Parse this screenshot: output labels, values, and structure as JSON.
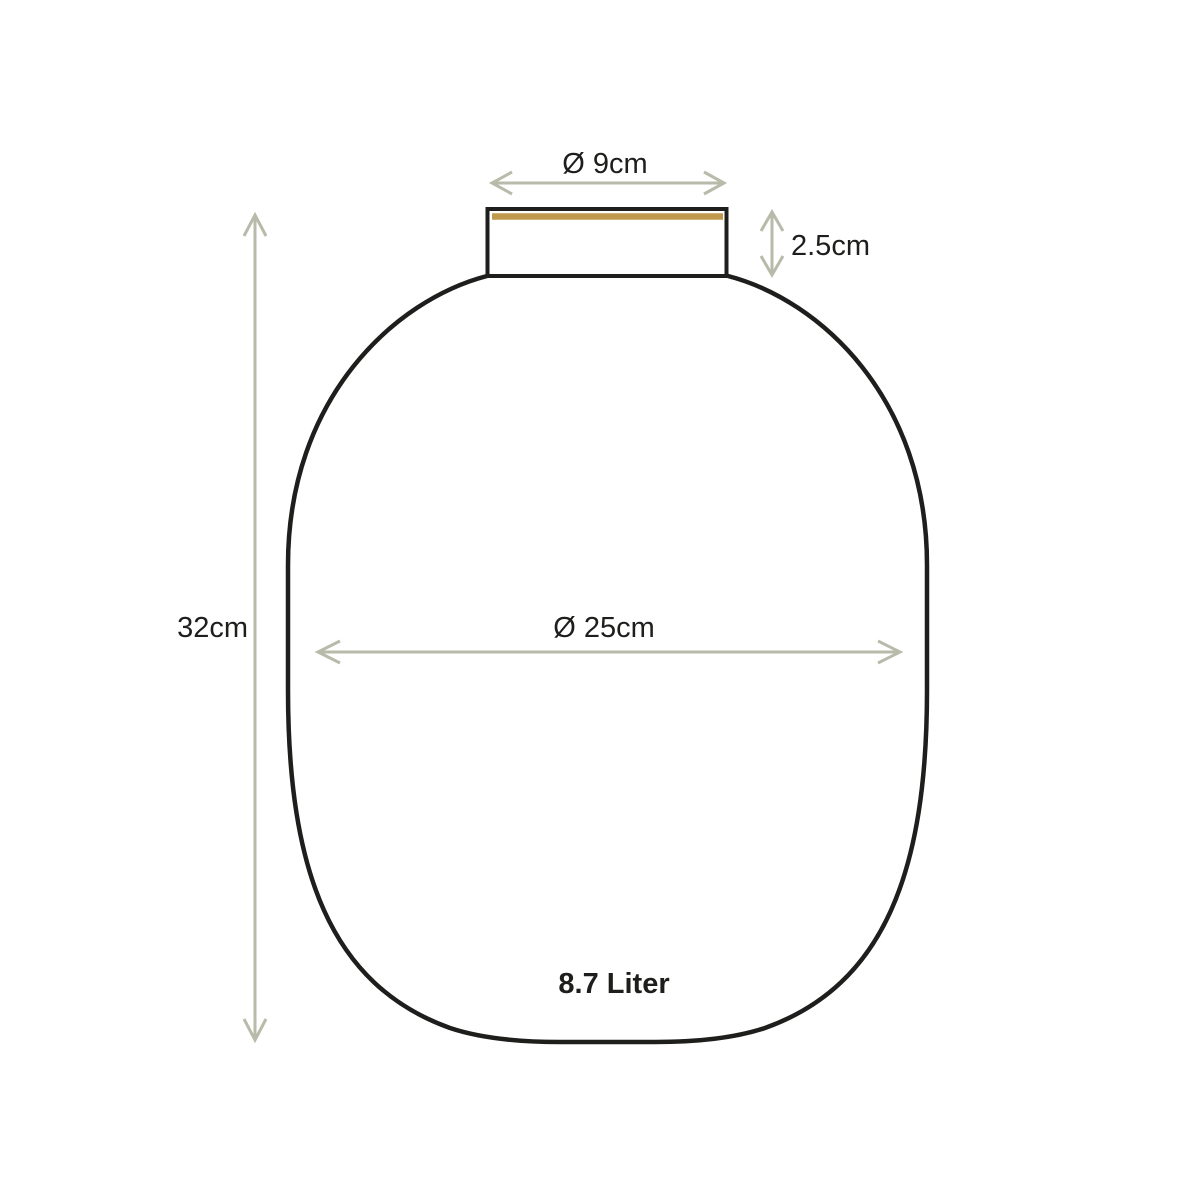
{
  "page": {
    "background_color": "#ffffff",
    "title": "Vase dimension diagram"
  },
  "vase": {
    "outline_color": "#1e1e1c",
    "accent_line_color": "#bf9a4d",
    "volume_label": "8.7 Liter"
  },
  "dimensions": {
    "color": "#b8baaa",
    "opening_diameter": {
      "label": "Ø 9cm"
    },
    "neck_height": {
      "label": "2.5cm"
    },
    "total_height": {
      "label": "32cm"
    },
    "body_diameter": {
      "label": "Ø 25cm"
    }
  }
}
